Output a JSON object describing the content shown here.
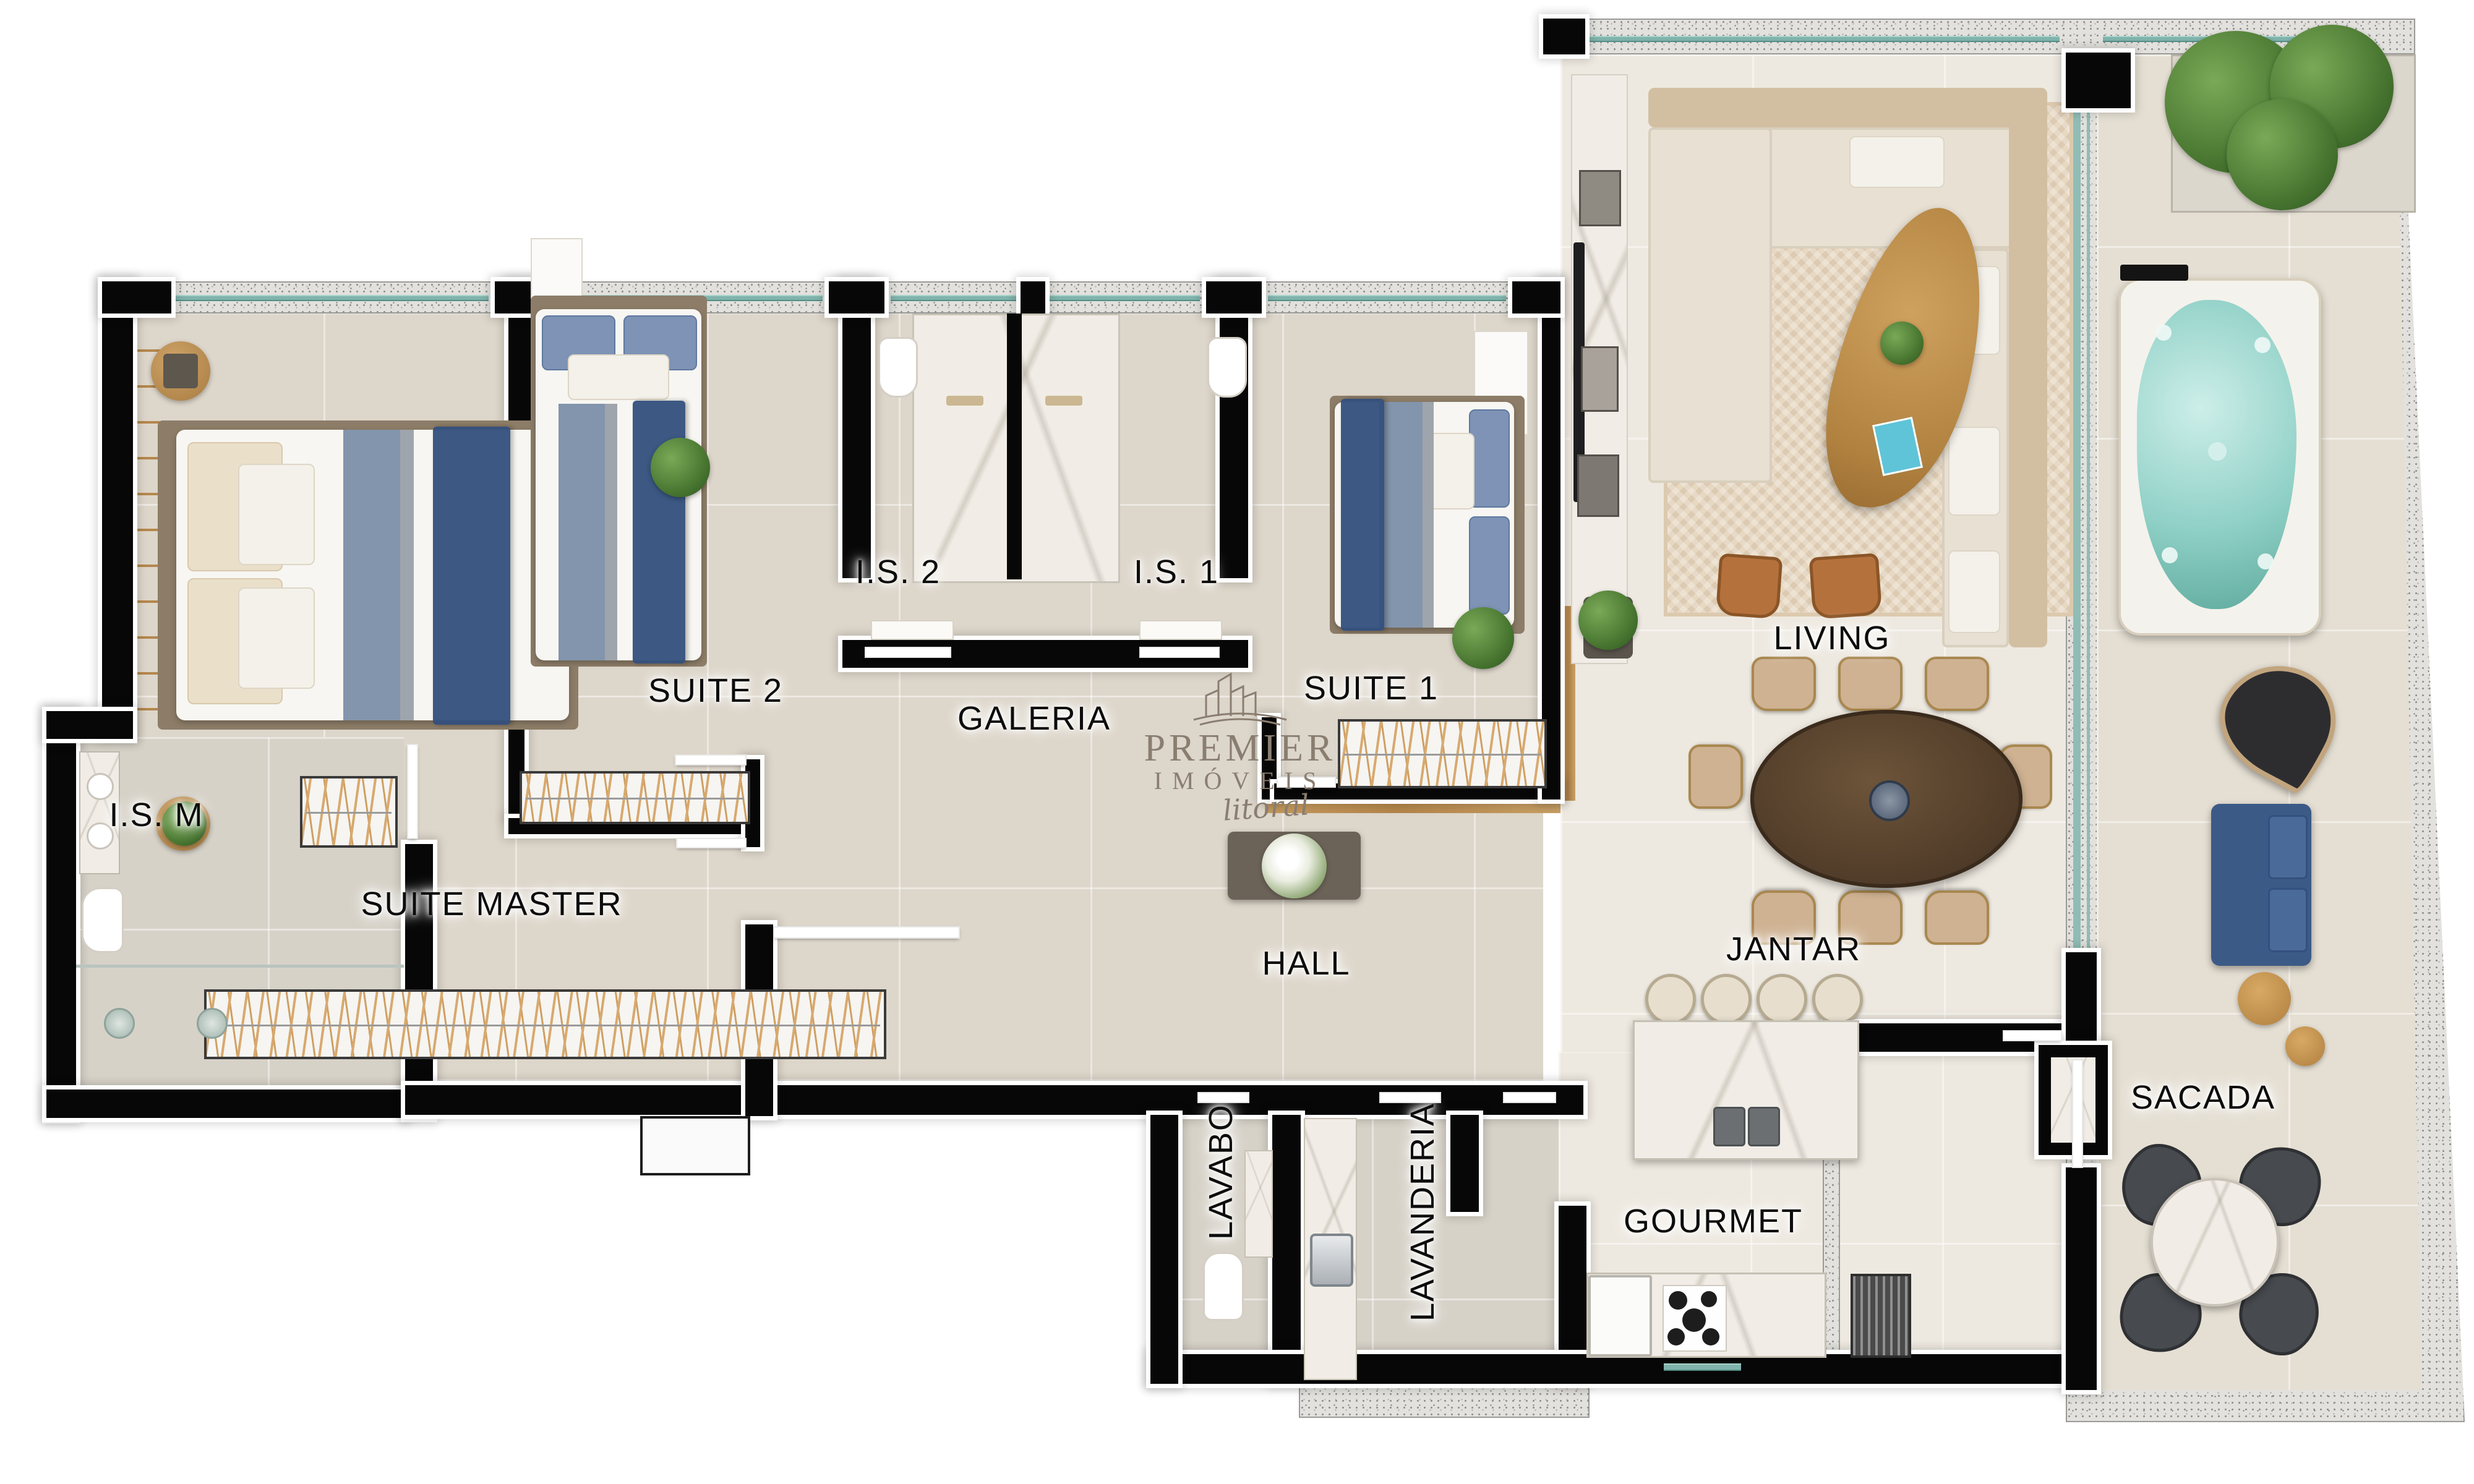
{
  "document": {
    "kind": "apartment floor plan, furnished top view render",
    "watermark_present": true
  },
  "brand": {
    "name": "PREMIER",
    "category": "IMÓVEIS",
    "tagline": "litoral",
    "icon": "buildings-logo-icon",
    "color": "#8a7e71"
  },
  "rooms": {
    "suite_master": "SUITE MASTER",
    "ism": "I.S. M",
    "suite_2": "SUITE 2",
    "is_2": "I.S. 2",
    "is_1": "I.S. 1",
    "galeria": "GALERIA",
    "suite_1": "SUITE 1",
    "living": "LIVING",
    "hall": "HALL",
    "jantar": "JANTAR",
    "lavabo": "LAVABO",
    "lavanderia": "LAVANDERIA",
    "gourmet": "GOURMET",
    "sacada": "SACADA"
  },
  "palette": {
    "interior_wall": "#070707",
    "wall_outline": "#ffffff",
    "exterior_wall_granite": "#e2e1dd",
    "window_glass": "#7fb3ab",
    "floor_bedrooms": "#ddd6ca",
    "floor_living": "#eee9e0",
    "floor_balcony": "#e5dfd3",
    "bed_navy_throw": "#33507e",
    "bed_steel_blue": "#7c8fa8",
    "wood": "#bf8f55",
    "hot_tub_water": "#8fd0c6",
    "leather_chair": "#b5713c",
    "marble": "#f1ede6",
    "plants": "#46742f",
    "balcony_daybed": "#3c5a86"
  }
}
